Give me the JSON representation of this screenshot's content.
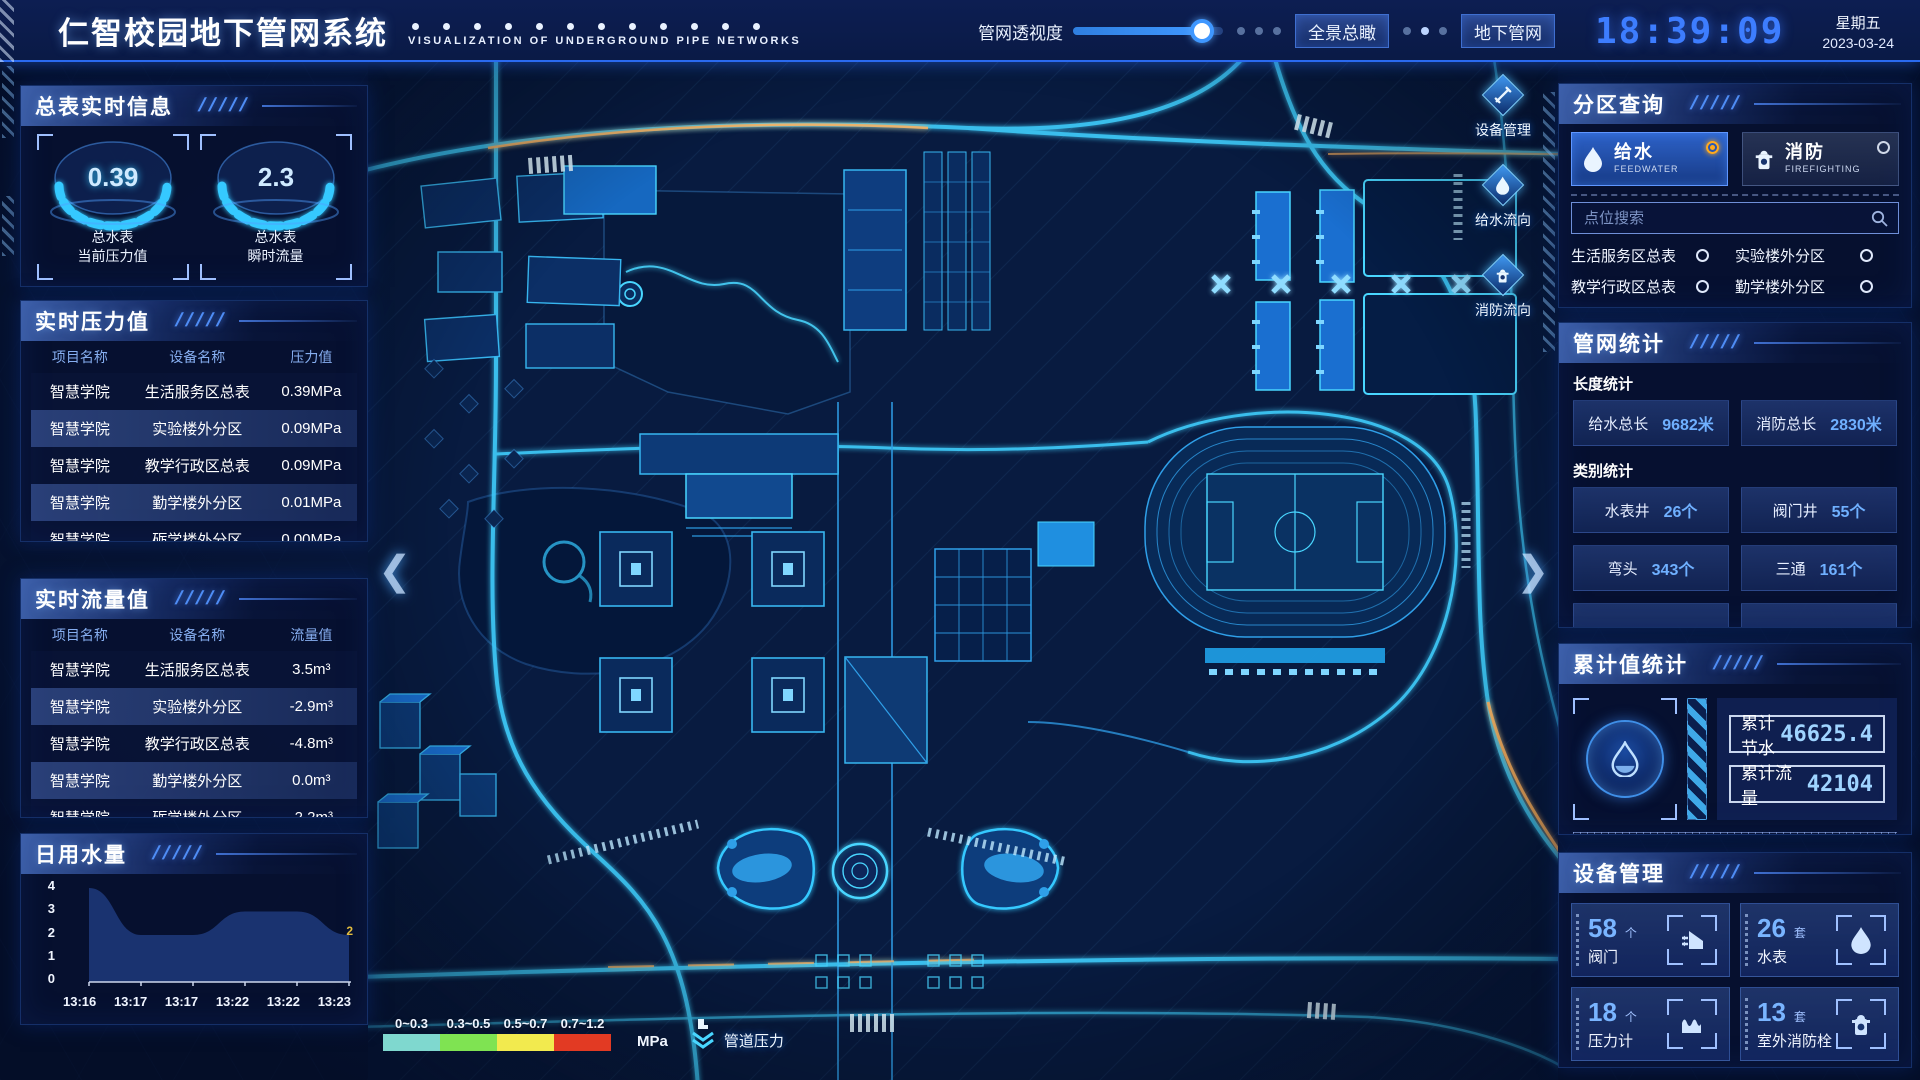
{
  "ui": {
    "slashes": "/////"
  },
  "header": {
    "title": "仁智校园地下管网系统",
    "subtitle": "VISUALIZATION OF UNDERGROUND PIPE NETWORKS",
    "slider_label": "管网透视度",
    "slider_value": 86,
    "btn_overview": "全景总瞰",
    "btn_underground": "地下管网",
    "time": "18:39:09",
    "weekday": "星期五",
    "date": "2023-03-24"
  },
  "left": {
    "summary": {
      "title": "总表实时信息",
      "gauges": [
        {
          "value": "0.39",
          "line1": "总水表",
          "line2": "当前压力值"
        },
        {
          "value": "2.3",
          "line1": "总水表",
          "line2": "瞬时流量"
        }
      ]
    },
    "pressure": {
      "title": "实时压力值",
      "headers": [
        "项目名称",
        "设备名称",
        "压力值"
      ],
      "rows": [
        {
          "project": "智慧学院",
          "device": "生活服务区总表",
          "value": "0.39MPa"
        },
        {
          "project": "智慧学院",
          "device": "实验楼外分区",
          "value": "0.09MPa"
        },
        {
          "project": "智慧学院",
          "device": "教学行政区总表",
          "value": "0.09MPa"
        },
        {
          "project": "智慧学院",
          "device": "勤学楼外分区",
          "value": "0.01MPa"
        },
        {
          "project": "智慧学院",
          "device": "砺学楼外分区",
          "value": "0.00MPa"
        }
      ]
    },
    "flow": {
      "title": "实时流量值",
      "headers": [
        "项目名称",
        "设备名称",
        "流量值"
      ],
      "rows": [
        {
          "project": "智慧学院",
          "device": "生活服务区总表",
          "value": "3.5m³"
        },
        {
          "project": "智慧学院",
          "device": "实验楼外分区",
          "value": "-2.9m³"
        },
        {
          "project": "智慧学院",
          "device": "教学行政区总表",
          "value": "-4.8m³"
        },
        {
          "project": "智慧学院",
          "device": "勤学楼外分区",
          "value": "0.0m³"
        },
        {
          "project": "智慧学院",
          "device": "砺学楼外分区",
          "value": "-2.2m³"
        }
      ]
    },
    "daily": {
      "title": "日用水量"
    }
  },
  "chart_data": {
    "type": "area",
    "title": "日用水量",
    "x": [
      "13:16",
      "13:17",
      "13:17",
      "13:22",
      "13:22",
      "13:23"
    ],
    "values": [
      4,
      2,
      2,
      3,
      3,
      2
    ],
    "yticks": [
      4,
      3,
      2,
      1,
      0
    ],
    "ylim": [
      0,
      4
    ],
    "end_label": "2",
    "grid": false,
    "legend": "none"
  },
  "right": {
    "query": {
      "title": "分区查询",
      "tabs": [
        {
          "label": "给水",
          "sub": "FEEDWATER",
          "selected": true
        },
        {
          "label": "消防",
          "sub": "FIREFIGHTING",
          "selected": false
        }
      ],
      "search_placeholder": "点位搜索",
      "items": [
        "生活服务区总表",
        "实验楼外分区",
        "教学行政区总表",
        "勤学楼外分区",
        "砺学楼外分区",
        "宿舍区泵房"
      ]
    },
    "stats": {
      "title": "管网统计",
      "length_label": "长度统计",
      "length": [
        {
          "label": "给水总长",
          "value": "9682米"
        },
        {
          "label": "消防总长",
          "value": "2830米"
        }
      ],
      "cat_label": "类别统计",
      "cats": [
        {
          "label": "水表井",
          "value": "26个"
        },
        {
          "label": "阀门井",
          "value": "55个"
        },
        {
          "label": "弯头",
          "value": "343个"
        },
        {
          "label": "三通",
          "value": "161个"
        }
      ]
    },
    "cumulative": {
      "title": "累计值统计",
      "items": [
        {
          "label": "累计节水",
          "value": "46625.4"
        },
        {
          "label": "累计流量",
          "value": "42104"
        }
      ]
    },
    "devices": {
      "title": "设备管理",
      "cards": [
        {
          "num": "58",
          "unit": "个",
          "label": "阀门"
        },
        {
          "num": "26",
          "unit": "套",
          "label": "水表"
        },
        {
          "num": "18",
          "unit": "个",
          "label": "压力计"
        },
        {
          "num": "13",
          "unit": "套",
          "label": "室外消防栓"
        }
      ]
    }
  },
  "map": {
    "toolbar": [
      {
        "label": "设备管理"
      },
      {
        "label": "给水流向"
      },
      {
        "label": "消防流向"
      }
    ],
    "legend": {
      "ranges": [
        {
          "label": "0~0.3",
          "color": "#7fd8cf"
        },
        {
          "label": "0.3~0.5",
          "color": "#7fe352"
        },
        {
          "label": "0.5~0.7",
          "color": "#f2ea4e"
        },
        {
          "label": "0.7~1.2",
          "color": "#e23a23"
        }
      ],
      "unit": "MPa",
      "button": "管道压力"
    }
  },
  "colors": {
    "accent": "#35c9ff",
    "highlight": "#ffaa1e"
  }
}
